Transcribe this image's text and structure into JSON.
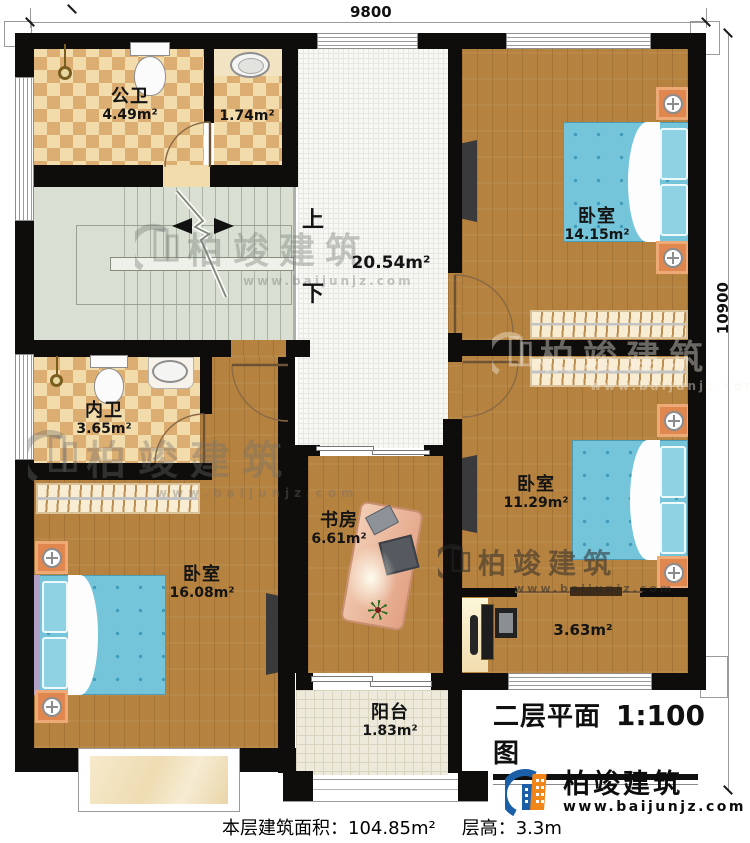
{
  "dimensions": {
    "width": "9800",
    "height": "10900"
  },
  "rooms": {
    "public_bath": {
      "name": "公卫",
      "area": "4.49m²"
    },
    "wash": {
      "area": "1.74m²"
    },
    "hall": {
      "area": "20.54m²"
    },
    "bedroom_top": {
      "name": "卧室",
      "area": "14.15m²"
    },
    "private_bath": {
      "name": "内卫",
      "area": "3.65m²"
    },
    "bedroom_right": {
      "name": "卧室",
      "area": "11.29m²"
    },
    "bedroom_left": {
      "name": "卧室",
      "area": "16.08m²"
    },
    "study": {
      "name": "书房",
      "area": "6.61m²"
    },
    "corridor": {
      "area": "3.63m²"
    },
    "balcony": {
      "name": "阳台",
      "area": "1.83m²"
    }
  },
  "stairs": {
    "up": "上",
    "down": "下"
  },
  "title": {
    "name": "二层平面图",
    "scale": "1:100"
  },
  "brand": {
    "name": "柏竣建筑",
    "url": "www.baijunjz.com",
    "accent_blue": "#1b5fa8",
    "accent_orange": "#f08619"
  },
  "watermark": {
    "name": "柏竣建筑",
    "url": "www.baijunjz.com"
  },
  "footer": {
    "area_label": "本层建筑面积：",
    "area_value": "104.85m²",
    "height_label": "层高：",
    "height_value": "3.3m"
  },
  "colors": {
    "wall": "#0e0d0b",
    "wood": "#b5823f",
    "tile_light": "#f3dcab",
    "tile_dark": "#dcae72",
    "stairs": "#d9dfd3",
    "hall": "#f7f7f3",
    "bed": "#74c4da",
    "balcony": "#edeadb",
    "bay_window": "#f3e3c3"
  }
}
